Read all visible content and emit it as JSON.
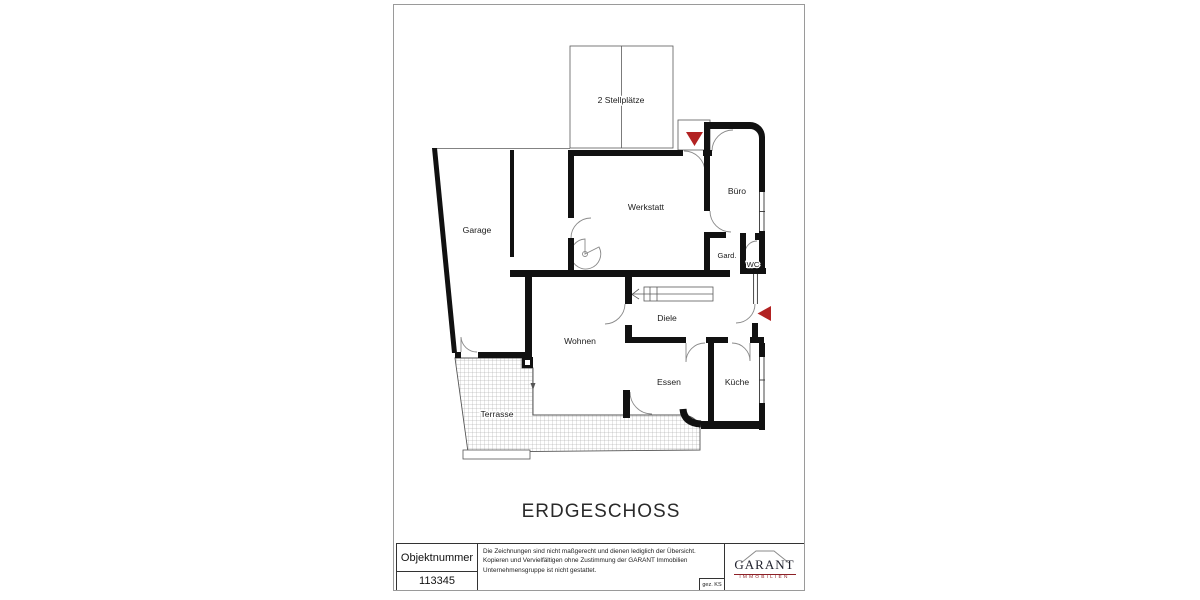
{
  "floor_plan": {
    "title": "ERDGESCHOSS",
    "rooms": {
      "stellplaetze": "2 Stellplätze",
      "garage": "Garage",
      "werkstatt": "Werkstatt",
      "buero": "Büro",
      "garderobe": "Gard.",
      "wc": "WC",
      "diele": "Diele",
      "wohnen": "Wohnen",
      "essen": "Essen",
      "kueche": "Küche",
      "terrasse": "Terrasse"
    },
    "colors": {
      "wall": "#111111",
      "entrance_marker": "#b22222"
    }
  },
  "title_block": {
    "object_number_label": "Objektnummer",
    "object_number": "113345",
    "disclaimer": "Die Zeichnungen sind nicht maßgerecht und dienen lediglich der Übersicht. Kopieren und Vervielfältigen ohne Zustimmung der GARANT Immobilien Unternehmensgruppe ist nicht gestattet.",
    "drawn_by": "gez. KS",
    "logo": {
      "brand": "GARANT",
      "tagline": "IMMOBILIEN"
    }
  }
}
